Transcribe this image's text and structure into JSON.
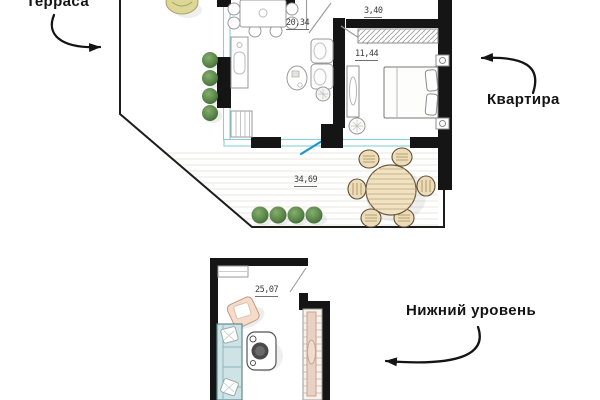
{
  "annotations": [
    {
      "id": "terrace",
      "label": "Терраса"
    },
    {
      "id": "apartment",
      "label": "Квартира"
    },
    {
      "id": "lower_level",
      "label": "Нижний уровень"
    }
  ],
  "upper_plan": {
    "name": "apartment-with-terrace",
    "rooms": [
      {
        "id": "living-kitchen",
        "area": "20,34"
      },
      {
        "id": "hall",
        "area": "3,40"
      },
      {
        "id": "bedroom",
        "area": "11,44"
      },
      {
        "id": "terrace",
        "area": "34,69"
      }
    ]
  },
  "lower_plan": {
    "name": "lower-level",
    "rooms": [
      {
        "id": "lounge",
        "area": "25,07"
      }
    ]
  },
  "colors": {
    "wall": "#151515",
    "outline": "#8c8c8c",
    "window_frame": "#87d1d6",
    "open_door": "#1b93cf",
    "plant_green": "#5d8a4c",
    "sofa_teal": "#cde3e6",
    "wood_tan": "#f1e3c2",
    "stair_pink": "#ead2c2",
    "chair_pink": "#f6dbc9"
  }
}
